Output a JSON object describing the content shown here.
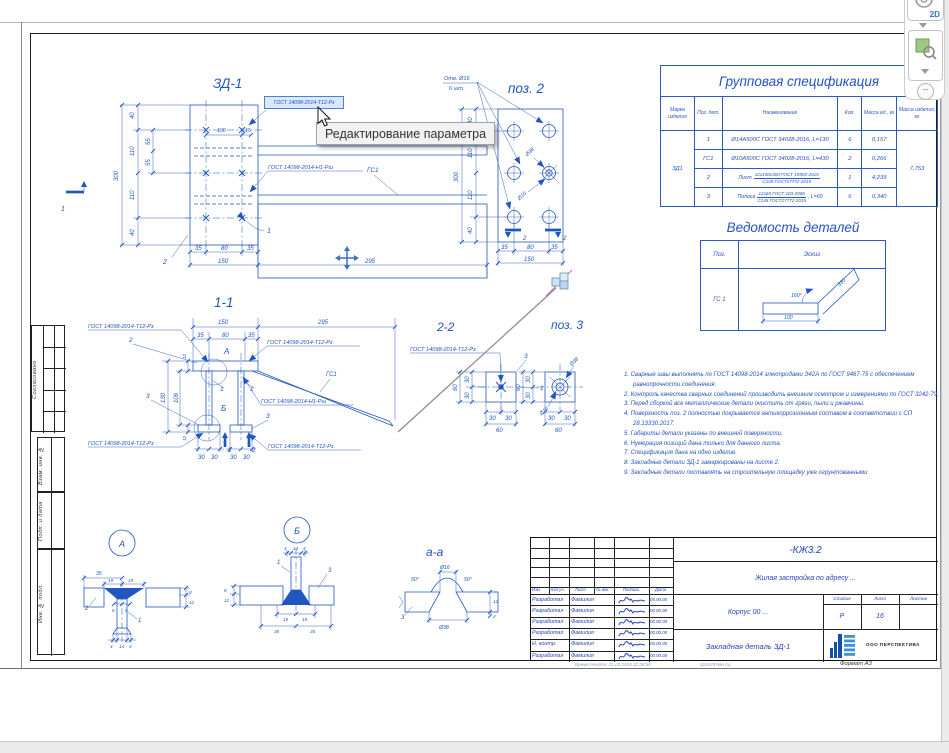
{
  "toolbar": {
    "view2d": "2D"
  },
  "tooltip": "Редактирование параметра",
  "side_stamp": {
    "agreed": "Согласовано",
    "vzam": "Взам. инв. №",
    "podp": "Подп. и дата",
    "inv": "Инв. № подл."
  },
  "spec_table": {
    "title": "Групповая спецификация",
    "headers": [
      "Марка изделия",
      "Поз. дет.",
      "Наименование",
      "Кол.",
      "Масса ед., кг",
      "Масса изделия, кг"
    ],
    "mark": "ЗД1",
    "total_mass": "7,753",
    "rows": [
      {
        "pos": "1",
        "name": "Ø14А500С  ГОСТ 34028-2016, L=130",
        "qty": "6",
        "mass": "0,157"
      },
      {
        "pos": "ГС1",
        "name": "Ø10А500С  ГОСТ 34028-2016, L=430",
        "qty": "2",
        "mass": "0,266"
      },
      {
        "pos": "2",
        "prefix": "Лист",
        "frac_top": "12х150х300 ГОСТ 19903-2015",
        "frac_bot": "С245 ГОСТ27772-2015",
        "suffix": "",
        "qty": "1",
        "mass": "4,239"
      },
      {
        "pos": "3",
        "prefix": "Полоса",
        "frac_top": "12х60 ГОСТ 103-2006",
        "frac_bot": "С245 ГОСТ27772-2015",
        "suffix": ", L=60",
        "qty": "6",
        "mass": "0,340"
      }
    ]
  },
  "parts_list": {
    "title": "Ведомость деталей",
    "pos_header": "Поз.",
    "sketch_header": "Эскиз",
    "row_pos": "ГС 1",
    "sketch": {
      "len": "100",
      "len2": "330",
      "angle": "160°"
    }
  },
  "notes": [
    "1. Сварные швы выполнять по ГОСТ 14098-2014 электродами Э42А по ГОСТ 9467-75 с обеспечением равнопрочности соединения.",
    "2. Контроль качества сварных соединений производить внешним осмотром и измерениями по ГОСТ 3242-79.",
    "3. Перед сборкой все металлические детали очистить от грязи, пыли и ржавчины.",
    "4. Поверхность поз. 2 полностью покрывается антикоррозионным составом в соответствии с СП 28.13330.2017.",
    "5. Габариты детали указаны по внешней поверхности.",
    "6. Нумерация позиций дана только для данного листа.",
    "7. Спецификация дана на одно изделие.",
    "8. Закладные детали ЗД-1 замаркированы на листе 2.",
    "9. Закладные детали поставлять на строительную площадку уже огрунтованными"
  ],
  "title_block": {
    "doc_code": "-КЖ3.2",
    "project": "Жилая застройка по адресу ...",
    "object": "Корпус 00 ...",
    "sheet_name": "Закладная деталь ЗД-1",
    "stage_label": "Стадия",
    "sheet_label": "Лист",
    "sheets_label": "Листов",
    "stage": "Р",
    "sheet_no": "16",
    "company": "ООО ПЕРСПЕКТИВА",
    "cols": [
      "Изм.",
      "Кол.уч.",
      "Лист",
      "№ док.",
      "Подпись",
      "Дата"
    ],
    "rows": [
      {
        "role": "Разработал",
        "name": "Фамилия",
        "date": "00.00.00"
      },
      {
        "role": "Разработал",
        "name": "Фамилия",
        "date": "00.00.00"
      },
      {
        "role": "Разработал",
        "name": "Фамилия",
        "date": "00.00.00"
      },
      {
        "role": "Разработал",
        "name": "Фамилия",
        "date": "00.00.00"
      },
      {
        "role": "Н. контр.",
        "name": "Фамилия",
        "date": "00.00.00"
      },
      {
        "role": "Разработал",
        "name": "Фамилия",
        "date": "00.00.00"
      }
    ],
    "print_info": "Время печати: 21.01.2016 12:28:58",
    "paper": "420х297мм (х)",
    "format": "Формат А3"
  },
  "drawing": {
    "selected_param": "ГОСТ 14098-2014-Т12-Рз",
    "gost_t12": "ГОСТ 14098-2014-Т12-Рз",
    "gost_n1": "ГОСТ 14098-2014-Н1-Рш",
    "gs1": "ГС1",
    "zd1": {
      "texts": [
        "ЗД-1",
        "300",
        "40",
        "110",
        "55",
        "55",
        "110",
        "40",
        "100",
        "15",
        "35",
        "80",
        "35",
        "150",
        "295",
        "1",
        "2",
        "1"
      ]
    },
    "pos2": {
      "texts": [
        "поз. 2",
        "Отв. Ø16",
        "6 шт.",
        "300",
        "40",
        "110",
        "110",
        "40",
        "Ø38",
        "Ø16",
        "35",
        "80",
        "35",
        "150",
        "2",
        "2"
      ]
    },
    "s11": {
      "texts": [
        "1-1",
        "150",
        "295",
        "35",
        "80",
        "35",
        "130",
        "106",
        "12",
        "12",
        "30",
        "30",
        "30",
        "30",
        "2",
        "2",
        "А",
        "Б",
        "2",
        "1",
        "1",
        "3",
        "3"
      ]
    },
    "s22": {
      "texts": [
        "2-2",
        "60",
        "30",
        "30",
        "60",
        "30",
        "30",
        "3",
        "1"
      ]
    },
    "pos3": {
      "texts": [
        "поз. 3",
        "60",
        "30",
        "30",
        "60",
        "30",
        "30",
        "Ø38",
        "Ø16"
      ]
    },
    "dA": {
      "texts": [
        "А",
        "35",
        "19",
        "19",
        "8",
        "8",
        "4",
        "14",
        "4",
        "2",
        "1",
        "8",
        "12"
      ]
    },
    "dB": {
      "texts": [
        "Б",
        "4",
        "14",
        "4",
        "19",
        "19",
        "35",
        "35",
        "1",
        "3",
        "8",
        "12"
      ]
    },
    "aa": {
      "texts": [
        "а-а",
        "Ø16",
        "50°",
        "50°",
        "Ø38",
        "3",
        "12",
        "4"
      ]
    }
  }
}
